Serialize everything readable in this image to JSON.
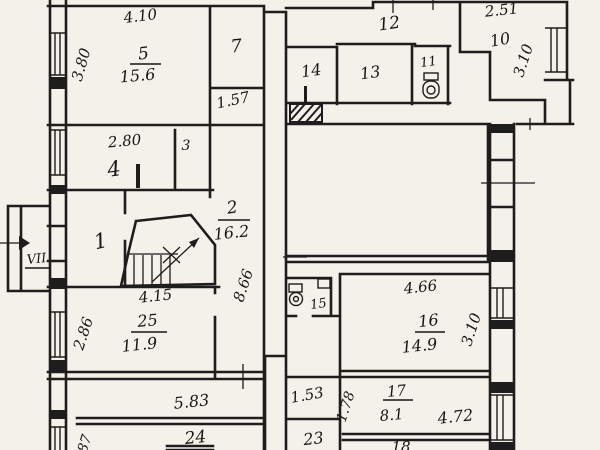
{
  "document": "hand-drawn apartment floor plan",
  "colors": {
    "paper": "#f3f1ea",
    "ink": "#1d1d1d"
  },
  "entrance": {
    "label": "VII"
  },
  "rooms": {
    "r1": {
      "number": "1"
    },
    "r2": {
      "number": "2",
      "area": "16.2"
    },
    "r3": {
      "number": "3"
    },
    "r4": {
      "number": "4"
    },
    "r5": {
      "number": "5",
      "area": "15.6"
    },
    "r7": {
      "number": "7"
    },
    "r10": {
      "number": "10"
    },
    "r11": {
      "number": "11"
    },
    "r12": {
      "number": "12"
    },
    "r13": {
      "number": "13"
    },
    "r14": {
      "number": "14"
    },
    "r15": {
      "number": "15"
    },
    "r16": {
      "number": "16",
      "area": "14.9"
    },
    "r17": {
      "number": "17",
      "area": "8.1"
    },
    "r18": {
      "number": "18"
    },
    "r23": {
      "number": "23"
    },
    "r24": {
      "number": "24"
    },
    "r25": {
      "number": "25",
      "area": "11.9"
    }
  },
  "dimensions": {
    "top_room5": "4.10",
    "left_room5": "3.80",
    "below_room7": "1.57",
    "room4_width": "2.80",
    "room10_width": "2.51",
    "room10_depth": "3.10",
    "hall_length": "8.66",
    "room25_width": "4.15",
    "room25_left": "2.86",
    "corridor_length": "5.83",
    "left_bottom_partial": "87",
    "room16_width": "4.66",
    "room16_depth": "3.10",
    "corridor23": "1.53",
    "room17_left": "1.78",
    "room17_width": "4.72"
  }
}
